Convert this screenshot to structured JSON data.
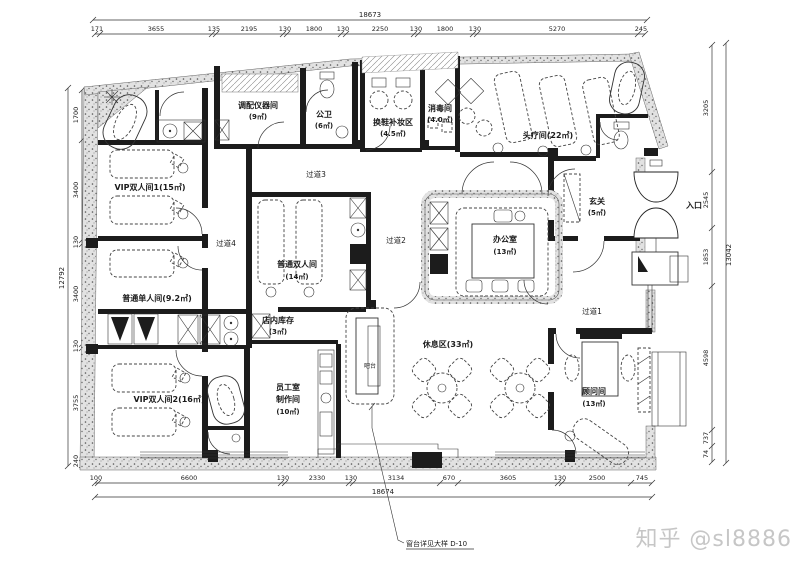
{
  "watermark": "知乎 @sl8886",
  "note": "窗台详见大样 D-10",
  "entrance": "入口",
  "rooms": {
    "vip1": {
      "lines": [
        "VIP双人间1(15㎡)"
      ]
    },
    "single": {
      "lines": [
        "普通单人间(9.2㎡)"
      ]
    },
    "vip2": {
      "lines": [
        "VIP双人间2(16㎡)"
      ]
    },
    "equip": {
      "lines": [
        "调配仪器间",
        "(9㎡)"
      ]
    },
    "wc": {
      "lines": [
        "公卫",
        "(6㎡)"
      ]
    },
    "shoe": {
      "lines": [
        "换鞋补妆区",
        "(4.5㎡)"
      ]
    },
    "disinfect": {
      "lines": [
        "消毒间",
        "(4.0㎡)"
      ]
    },
    "head": {
      "lines": [
        "头疗间(22㎡)"
      ]
    },
    "foyer": {
      "lines": [
        "玄关",
        "(5㎡)"
      ]
    },
    "office": {
      "lines": [
        "办公室",
        "(13㎡)"
      ]
    },
    "double": {
      "lines": [
        "普通双人间",
        "(14㎡)"
      ]
    },
    "stock": {
      "lines": [
        "店内库存",
        "(3㎡)"
      ]
    },
    "staff": {
      "lines": [
        "员工室",
        "制作间",
        "(10㎡)"
      ]
    },
    "rest": {
      "lines": [
        "休息区(33㎡)"
      ]
    },
    "consult": {
      "lines": [
        "顾问间",
        "(13㎡)"
      ]
    },
    "bar": {
      "lines": [
        "吧台"
      ]
    }
  },
  "corridors": {
    "c1": "过道1",
    "c2": "过道2",
    "c3": "过道3",
    "c4": "过道4"
  },
  "dims": {
    "top": {
      "total": "18673",
      "segments": [
        "171",
        "3655",
        "135",
        "2195",
        "130",
        "1800",
        "130",
        "2250",
        "130",
        "1800",
        "130",
        "5270",
        "245"
      ]
    },
    "bottom": {
      "total": "18674",
      "segments": [
        "100",
        "6600",
        "130",
        "2330",
        "130",
        "3134",
        "670",
        "3605",
        "130",
        "2500",
        "745"
      ]
    },
    "left": {
      "total": "12792",
      "segments": [
        "1700",
        "3400",
        "130",
        "3400",
        "130",
        "3755",
        "240"
      ]
    },
    "right": {
      "total": "13042",
      "segments": [
        "3205",
        "2545",
        "1853",
        "4598",
        "737",
        "74"
      ]
    }
  }
}
